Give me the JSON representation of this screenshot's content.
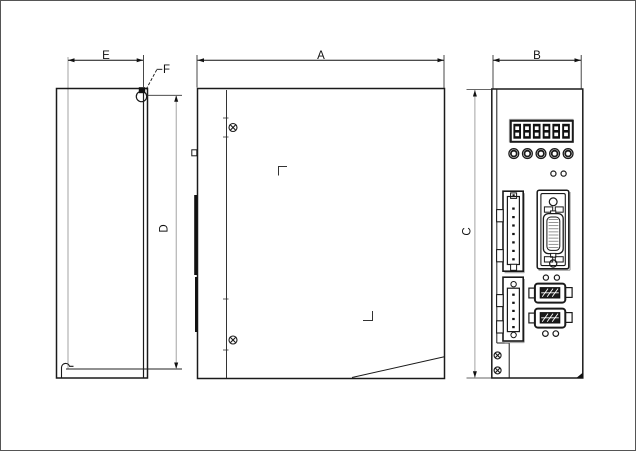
{
  "page": {
    "background": "#ffffff",
    "border_color": "#555555"
  },
  "drawing": {
    "labels": {
      "e": "E",
      "a": "A",
      "b": "B",
      "c": "C",
      "d": "D",
      "f": "F"
    },
    "line_color": "#1a1a1a",
    "dimension_line_color": "#999999",
    "shadow_color": "#aaaaaa",
    "front_panel": {
      "display_value": "888888",
      "digit_count": 6,
      "button_count": 5
    }
  }
}
